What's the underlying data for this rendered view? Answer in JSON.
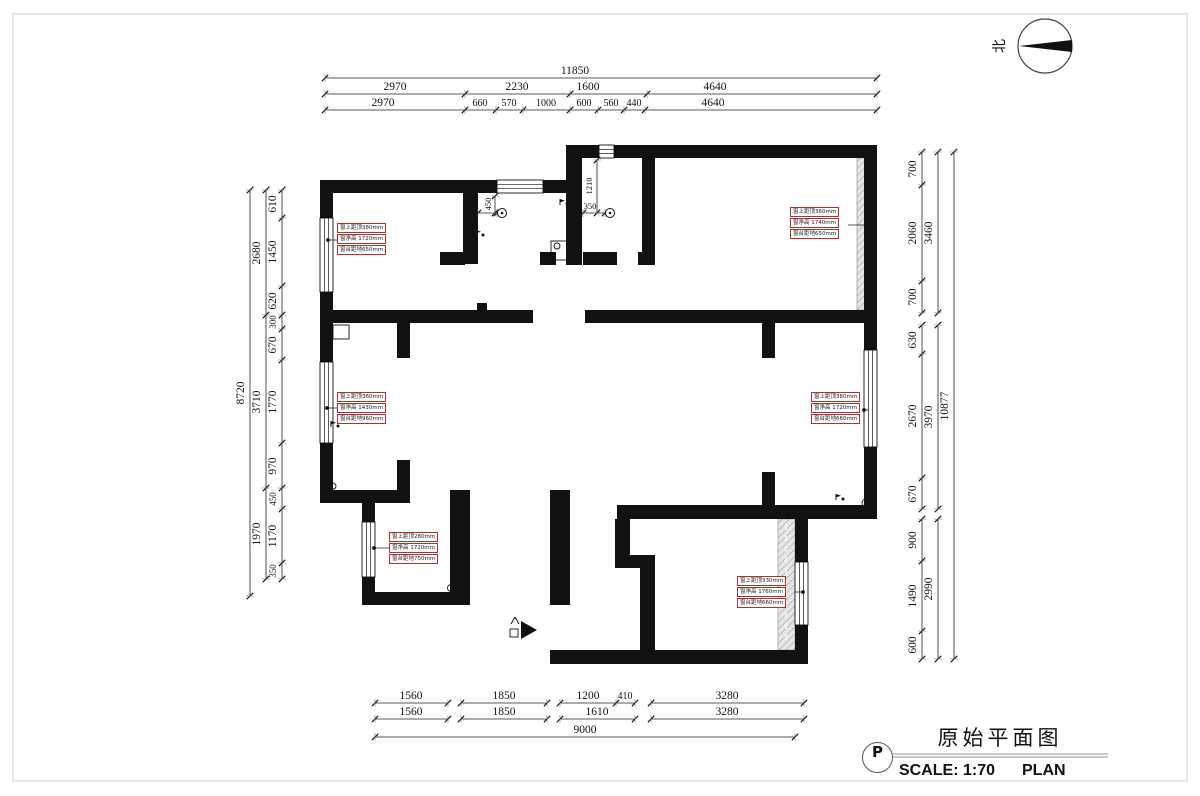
{
  "title_block": {
    "title": "原始平面图",
    "scale_label": "SCALE: 1:70",
    "plan_label": "PLAN",
    "tag": "P"
  },
  "north_indicator": {
    "label": "北"
  },
  "dimensions": {
    "top": {
      "total": "11850",
      "row2": [
        "2970",
        "2230",
        "1600",
        "4640"
      ],
      "row3": [
        "2970",
        "660",
        "570",
        "1000",
        "600",
        "560",
        "440",
        "4640"
      ]
    },
    "left": {
      "total": "8720",
      "row2": [
        "2680",
        "3710",
        "1970"
      ],
      "row3": [
        "610",
        "1450",
        "620",
        "300",
        "670",
        "1770",
        "970",
        "450",
        "1170",
        "350"
      ]
    },
    "right": {
      "total": "10877",
      "row2": [
        "3460",
        "3970",
        "2990"
      ],
      "row3": [
        "700",
        "2060",
        "700",
        "630",
        "2670",
        "670",
        "900",
        "1490",
        "600"
      ]
    },
    "bottom": {
      "total": "9000",
      "row1": [
        "1560",
        "1850",
        "1200",
        "410",
        "3280"
      ],
      "row2": [
        "1560",
        "1850",
        "1610",
        "3280"
      ]
    },
    "interior": [
      "360",
      "450",
      "350",
      "1210"
    ]
  },
  "window_labels": [
    {
      "lines": [
        "窗上距顶380mm",
        "窗净高 1720mm",
        "窗台距地650mm"
      ]
    },
    {
      "lines": [
        "窗上距顶360mm",
        "窗净高 1740mm",
        "窗台距地650mm"
      ]
    },
    {
      "lines": [
        "窗上距顶360mm",
        "窗净高 1430mm",
        "窗台距地960mm"
      ]
    },
    {
      "lines": [
        "窗上距顶380mm",
        "窗净高 1720mm",
        "窗台距地660mm"
      ]
    },
    {
      "lines": [
        "窗上距顶280mm",
        "窗净高 1720mm",
        "窗台距地750mm"
      ]
    },
    {
      "lines": [
        "窗上距顶330mm",
        "窗净高 1760mm",
        "窗台距地660mm"
      ]
    }
  ],
  "colors": {
    "wall": "#111111",
    "dimension_line": "#222222",
    "label_box_red": "#b03030",
    "hatch": "#bbbbbb"
  }
}
